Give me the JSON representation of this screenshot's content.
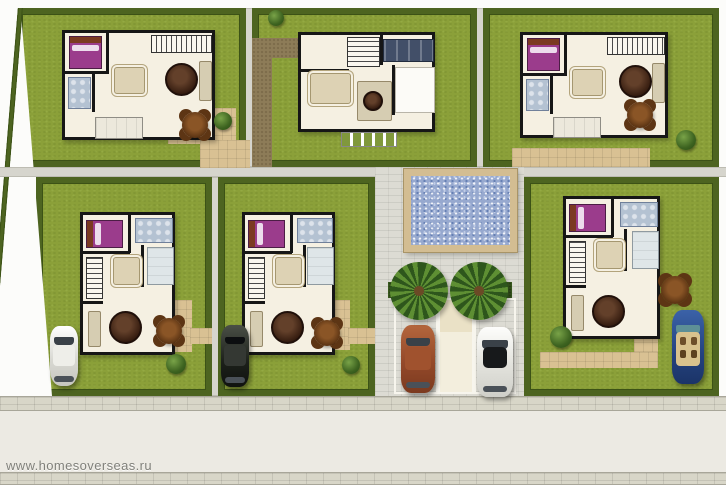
{
  "watermark": {
    "text": "www.homesoverseas.ru"
  },
  "site": {
    "villa_count": 6,
    "pool": "swimming-pool",
    "parking_stall_count": 3,
    "palm_tree_count": 2,
    "garden_table_count": 5
  },
  "cars": [
    {
      "name": "white-car",
      "location": "villa-plot-4",
      "color": "#e6e6e0"
    },
    {
      "name": "black-car",
      "location": "villa-plot-5",
      "color": "#1c201a"
    },
    {
      "name": "blue-convertible",
      "location": "villa-plot-6",
      "color": "#24427e"
    },
    {
      "name": "red-car",
      "location": "parking-stall-left",
      "color": "#94492a"
    },
    {
      "name": "white-car-parked",
      "location": "parking-stall-right",
      "color": "#e2e2dc"
    }
  ],
  "colors": {
    "lawn": "#8ba039",
    "hedge": "#4d6420",
    "plaza_paving": "#dcdbd3",
    "road": "#eceae3",
    "sidewalk": "#d8d6c8",
    "pool_water": "#97a9cf",
    "pool_deck": "#d3bd92",
    "path_tan": "#d9c193",
    "path_dirt": "#8d7c58",
    "house_wall": "#161616",
    "house_floor": "#f5f0e2",
    "bed": "#9b3c8c",
    "bath": "#b4c2d2"
  }
}
